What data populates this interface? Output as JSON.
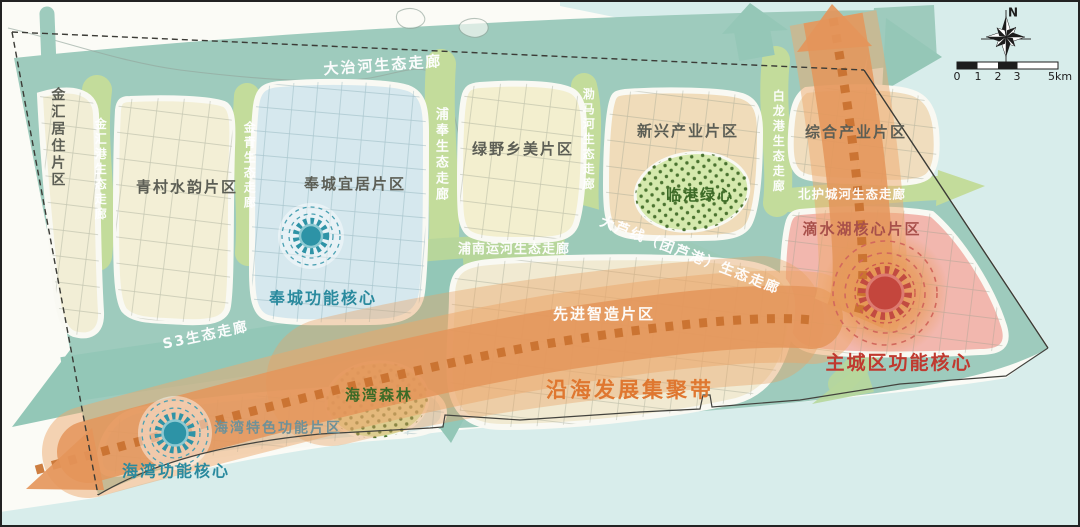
{
  "compass": {
    "north_label": "N"
  },
  "scalebar": {
    "ticks": [
      "0",
      "1",
      "2",
      "3"
    ],
    "end_label": "5km"
  },
  "districts": [
    {
      "label": "金汇居住片区"
    },
    {
      "label": "青村水韵片区"
    },
    {
      "label": "奉城宜居片区"
    },
    {
      "label": "绿野乡美片区"
    },
    {
      "label": "新兴产业片区"
    },
    {
      "label": "综合产业片区"
    },
    {
      "label": "滴水湖核心片区"
    },
    {
      "label": "先进智造片区"
    },
    {
      "label": "海湾特色功能片区"
    }
  ],
  "green_spaces": [
    {
      "label": "临港绿心"
    },
    {
      "label": "海湾森林"
    }
  ],
  "corridors": [
    {
      "label": "大治河生态走廊"
    },
    {
      "label": "金汇港生态走廊"
    },
    {
      "label": "金青生态走廊"
    },
    {
      "label": "浦奉生态走廊"
    },
    {
      "label": "泐马河生态走廊"
    },
    {
      "label": "白龙港生态走廊"
    },
    {
      "label": "北护城河生态走廊"
    },
    {
      "label": "浦南运河生态走廊"
    },
    {
      "label": "大芦线（团芦港）生态走廊"
    },
    {
      "label": "S3生态走廊"
    }
  ],
  "cores": [
    {
      "label": "奉城功能核心"
    },
    {
      "label": "海湾功能核心"
    },
    {
      "label": "主城区功能核心"
    }
  ],
  "belt": {
    "label": "沿海发展集聚带"
  },
  "colors": {
    "sea": "#d8edeb",
    "land_teal": "#9ecbbd",
    "corridor_green": "#c3dc9b",
    "belt_orange": "#e5965b",
    "belt_dash": "#c8702e",
    "core_teal": "#2d93a6",
    "core_red": "#c4463d",
    "green_space_fill": "#d5e9ad",
    "label_orange": "#df7730",
    "label_red": "#c0392f",
    "label_teal": "#2a8a9e",
    "label_green": "#3c6b27"
  }
}
